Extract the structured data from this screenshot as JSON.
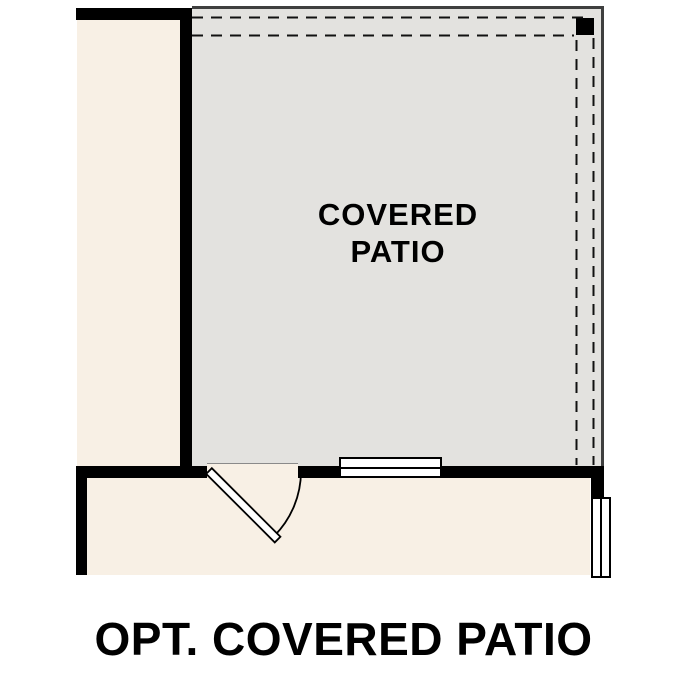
{
  "floor_plan": {
    "patio_label": {
      "line1": "COVERED",
      "line2": "PATIO"
    },
    "caption": "OPT. COVERED PATIO",
    "colors": {
      "background": "#ffffff",
      "interior_fill": "#f8f0e5",
      "patio_fill": "#e3e2df",
      "wall": "#000000",
      "patio_outline": "#3f3f3f",
      "dashed_line": "#111111",
      "text": "#000000"
    },
    "features": {
      "door": "door-swing",
      "window_bottom": "double-window",
      "window_right": "double-window",
      "post": "corner-post",
      "dashed_outline": "roof-overhang-dashed-outline"
    }
  }
}
